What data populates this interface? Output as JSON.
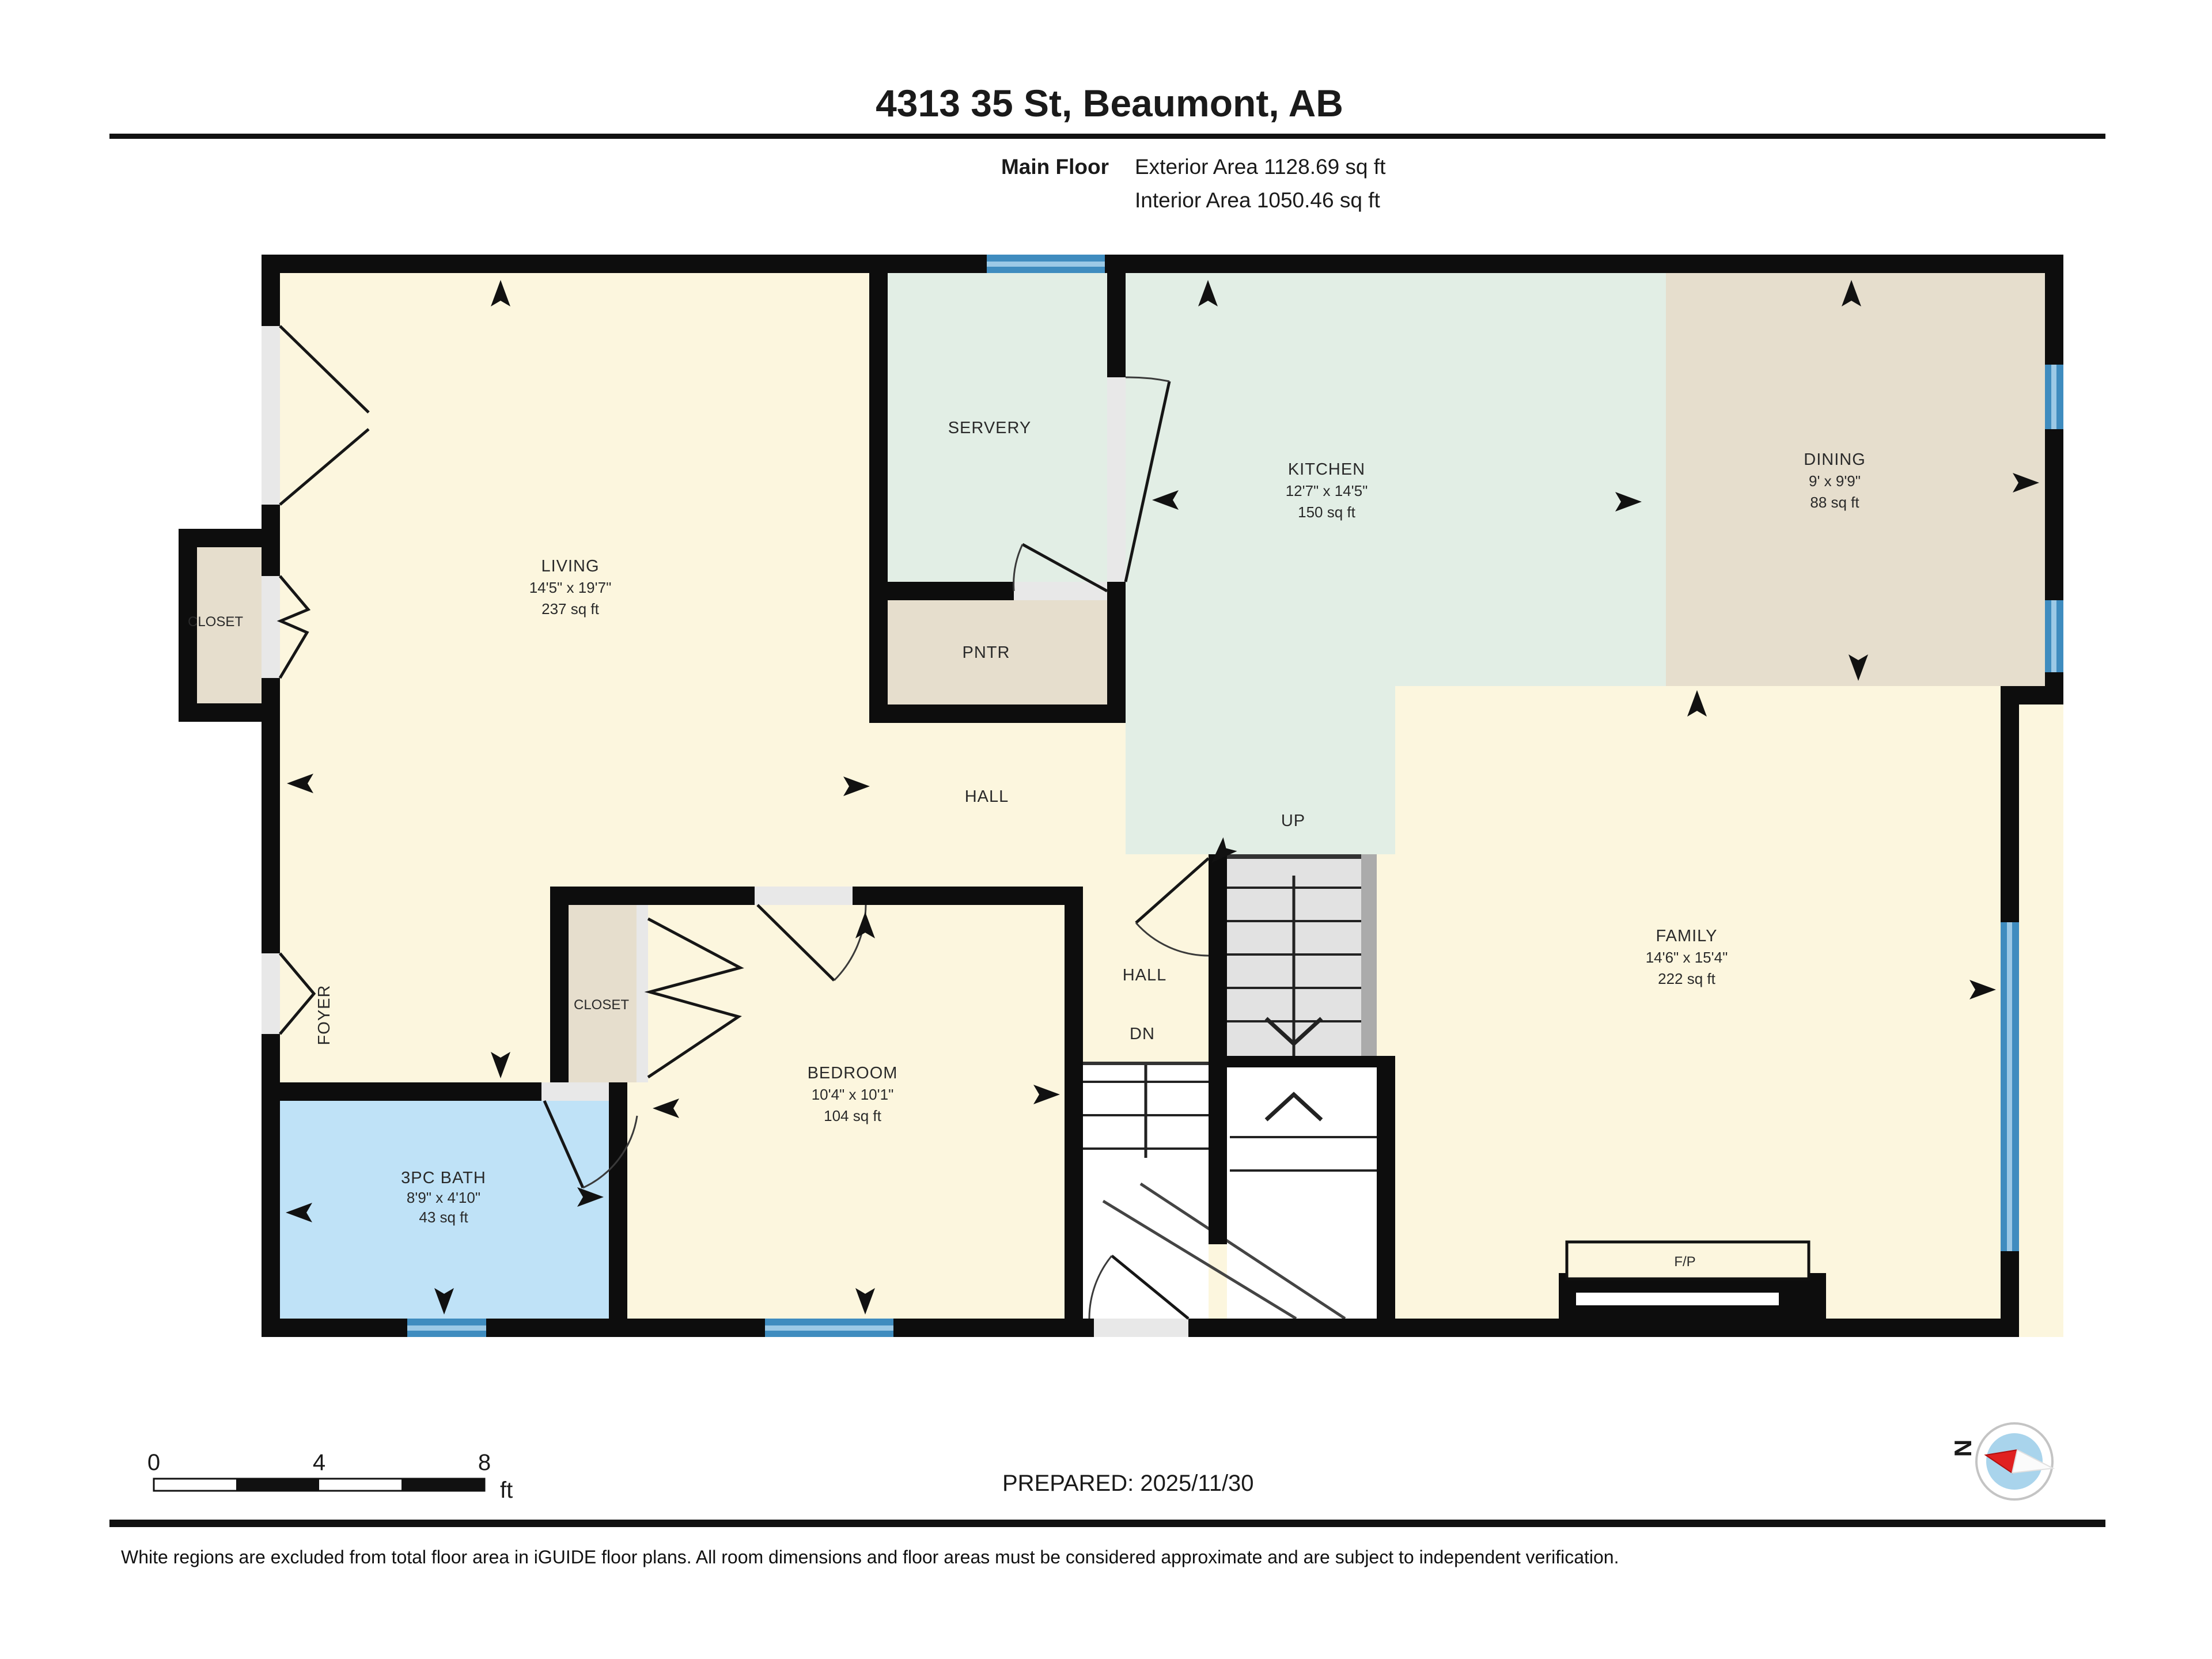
{
  "header": {
    "title": "4313 35 St, Beaumont, AB",
    "floor_label": "Main Floor",
    "exterior_area": "Exterior Area 1128.69 sq ft",
    "interior_area": "Interior Area 1050.46 sq ft"
  },
  "rooms": {
    "living": {
      "name": "LIVING",
      "dims": "14'5\" x 19'7\"",
      "area": "237 sq ft"
    },
    "servery": {
      "name": "SERVERY"
    },
    "kitchen": {
      "name": "KITCHEN",
      "dims": "12'7\" x 14'5\"",
      "area": "150 sq ft"
    },
    "dining": {
      "name": "DINING",
      "dims": "9' x 9'9\"",
      "area": "88 sq ft"
    },
    "pantry": {
      "name": "PNTR"
    },
    "closet_left": {
      "name": "CLOSET"
    },
    "closet_bedroom": {
      "name": "CLOSET"
    },
    "hall_main": {
      "name": "HALL"
    },
    "hall_small": {
      "name": "HALL"
    },
    "foyer": {
      "name": "FOYER"
    },
    "bedroom": {
      "name": "BEDROOM",
      "dims": "10'4\" x 10'1\"",
      "area": "104 sq ft"
    },
    "bath": {
      "name": "3PC BATH",
      "dims": "8'9\" x 4'10\"",
      "area": "43 sq ft"
    },
    "family": {
      "name": "FAMILY",
      "dims": "14'6\" x 15'4\"",
      "area": "222 sq ft"
    },
    "fireplace": {
      "name": "F/P"
    }
  },
  "stairs": {
    "up": "UP",
    "down": "DN"
  },
  "scale_bar": {
    "tick0": "0",
    "tick1": "4",
    "tick2": "8",
    "unit": "ft"
  },
  "prepared": "PREPARED: 2025/11/30",
  "compass": {
    "north": "N"
  },
  "disclaimer": "White regions are excluded from total floor area in iGUIDE floor plans. All room dimensions and floor areas must be considered approximate and are subject to independent verification.",
  "colors": {
    "room_cream": "#FCF6DE",
    "room_green": "#E2EEE5",
    "room_tan": "#E6DECD",
    "room_blue": "#BFE2F7",
    "window_blue": "#3F8CBF",
    "window_light": "#9CC9E6",
    "wall": "#0D0D0D"
  }
}
